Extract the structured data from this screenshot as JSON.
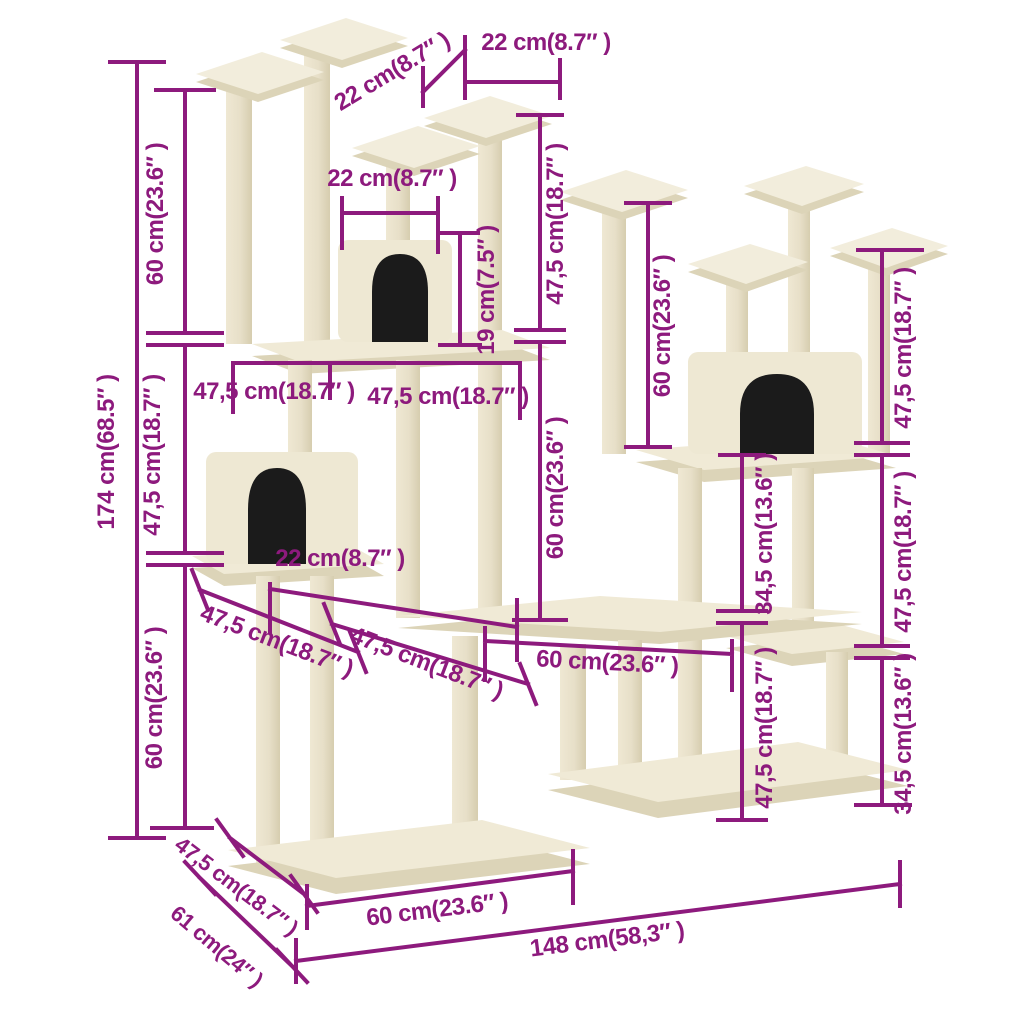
{
  "diagram": {
    "kind": "cat-tree-product-dimension-diagram",
    "colors": {
      "dimension_accent": "#8D1A7D",
      "wood_cream_top": "#F0EAD6",
      "wood_cream_shadow": "#DCD4B8",
      "post_cream": "#E9E2CC",
      "house_opening": "#1B1B1B",
      "background": "#FFFFFF"
    },
    "measurements": {
      "top_left_span": "22 cm(8.7″ )",
      "top_right_span": "22 cm(8.7″ )",
      "left_upper_segment": "60 cm(23.6″ )",
      "left_middle_segment": "47,5 cm(18.7″ )",
      "left_lower_segment": "60 cm(23.6″ )",
      "total_height": "174 cm(68.5″ )",
      "upper_house_width": "22 cm(8.7″ )",
      "upper_house_height": "19 cm(7.5″ )",
      "upper_post_height": "47,5 cm(18.7″ )",
      "mid_span_left": "47,5 cm(18.7″ )",
      "mid_span_right": "47,5 cm(18.7″ )",
      "center_post_height": "60 cm(23.6″ )",
      "right_tower_upper_height": "60 cm(23.6″ )",
      "right_upper_post": "47,5 cm(18.7″ )",
      "right_middle_post": "47,5 cm(18.7″ )",
      "right_lower_step": "34,5 cm(13.6″ )",
      "inner_right_step": "34,5 cm(13.6″ )",
      "inner_right_post": "47,5 cm(18.7″ )",
      "mid_platform_width": "60 cm(23.6″ )",
      "lower_house_width": "22 cm(8.7″ )",
      "lower_left_depth": "47,5 cm(18.7″ )",
      "lower_mid_depth": "47,5 cm(18.7″ )",
      "base_depth": "47,5 cm(18.7″ )",
      "base_side_depth": "61 cm(24″ )",
      "base_front_width": "60 cm(23.6″ )",
      "total_width": "148 cm(58,3″ )"
    }
  }
}
